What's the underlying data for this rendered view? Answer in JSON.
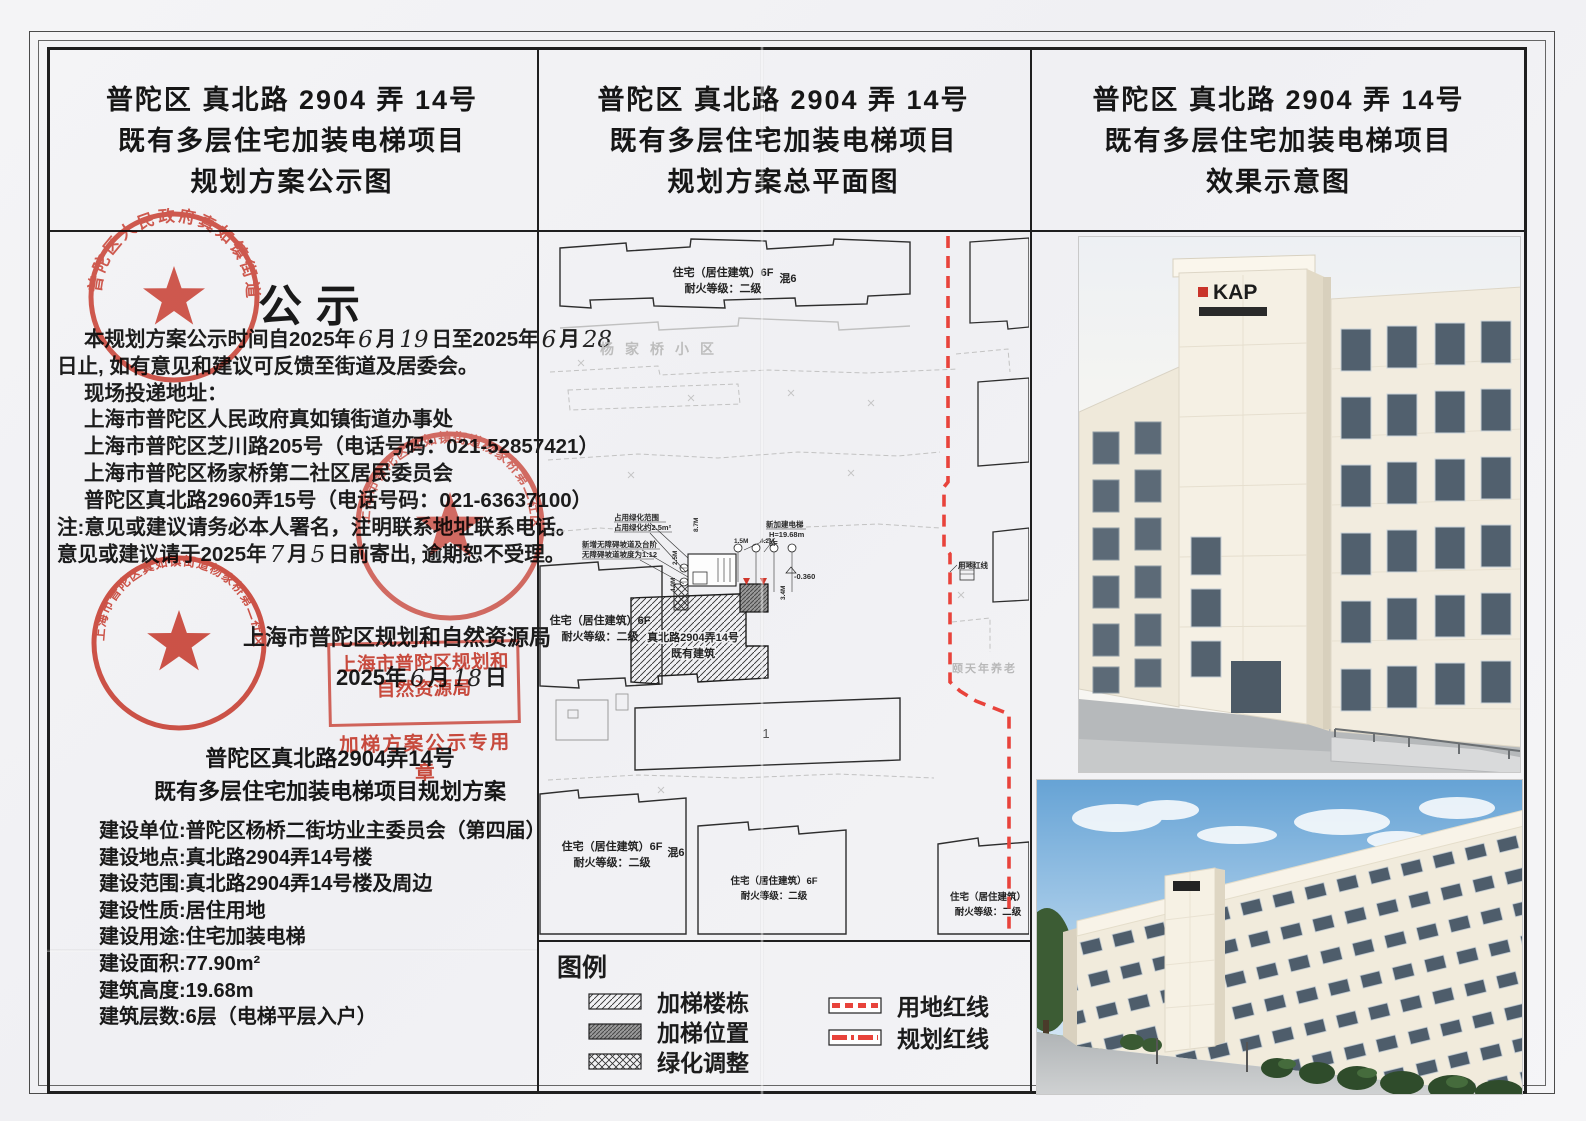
{
  "doc": {
    "title_line1": "普陀区 真北路 2904 弄 14号",
    "title_line2": "既有多层住宅加装电梯项目",
    "left_title_line3": "规划方案公示图",
    "mid_title_line3": "规划方案总平面图",
    "right_title_line3": "效果示意图"
  },
  "notice": {
    "heading": "公示",
    "line1_a": "本规划方案公示时间自2025年",
    "line1_m1": "6",
    "line1_b": "月",
    "line1_d1": "19",
    "line1_c": "日至2025年",
    "line1_m2": "6",
    "line1_d": "月",
    "line1_d2": "28",
    "line2": "日止, 如有意见和建议可反馈至街道及居委会。",
    "line3": "现场投递地址：",
    "addr1": "上海市普陀区人民政府真如镇街道办事处",
    "addr2": "上海市普陀区芝川路205号",
    "addr2_phone": "（电话号码：021-52857421）",
    "addr3": "上海市普陀区杨家桥第二社区居民委员会",
    "addr4": "普陀区真北路2960弄15号",
    "addr4_phone": "（电话号码：021-63637100）",
    "note1": "注:意见或建议请务必本人署名，注明联系地址联系电话。",
    "note2_a": "意见或建议请于2025年",
    "note2_m": "7",
    "note2_b": "月",
    "note2_d": "5",
    "note2_c": "日前寄出, 逾期恕不受理。"
  },
  "authority": {
    "name": "上海市普陀区规划和自然资源局",
    "date_a": "2025年",
    "date_m": "6",
    "date_b": "月",
    "date_d": "18",
    "date_c": "日",
    "stamp_line1": "上海市普陀区规划和自然资源局",
    "stamp_line2": "加梯方案公示专用章"
  },
  "stamps": {
    "street_office": "普陀区人民政府真如镇街道办事处",
    "community": "上海市普陀区真如镇街道杨家桥第二社区居民委员会"
  },
  "project": {
    "name_line1": "普陀区真北路2904弄14号",
    "name_line2": "既有多层住宅加装电梯项目规划方案",
    "fields": [
      {
        "label": "建设单位:",
        "value": "普陀区杨桥二街坊业主委员会（第四届）"
      },
      {
        "label": "建设地点:",
        "value": "真北路2904弄14号楼"
      },
      {
        "label": "建设范围:",
        "value": "真北路2904弄14号楼及周边"
      },
      {
        "label": "建设性质:",
        "value": "居住用地"
      },
      {
        "label": "建设用途:",
        "value": "住宅加装电梯"
      },
      {
        "label": "建设面积:",
        "value": "77.90m²"
      },
      {
        "label": "建筑高度:",
        "value": "19.68m"
      },
      {
        "label": "建筑层数:",
        "value": "6层（电梯平层入户）"
      }
    ]
  },
  "plan": {
    "res_label1": "住宅（居住建筑）6F",
    "res_label2": "耐火等级：二级",
    "res_label_short": "住宅（居住建筑）",
    "neighborhood": "杨家桥小区",
    "care_home": "颐天年养老",
    "redline_label": "用地红线",
    "existing1": "真北路2904弄14号",
    "existing2": "既有建筑",
    "ann_green1": "占用绿化范围",
    "ann_green2": "占用绿化约2.5m²",
    "ann_lift1": "新加建电梯",
    "ann_lift2": "H=19.68m",
    "ann_lift3": "6F",
    "ann_ramp1": "新增无障碍坡道及台阶",
    "ann_ramp2": "无障碍坡道坡度为1:12",
    "level": "-0.360",
    "dim_87": "8.7M",
    "dim_42": "4.2M",
    "dim_15": "1.5M",
    "dim_25": "2.5M",
    "dim_40": "4.0M",
    "dim_34": "3.4M",
    "block_no": "1",
    "gray_mark": "混6"
  },
  "legend": {
    "title": "图例",
    "item1": "加梯楼栋",
    "item2": "加梯位置",
    "item3": "绿化调整",
    "item4": "用地红线",
    "item5": "规划红线"
  },
  "render": {
    "logo_top": "KAP"
  },
  "colors": {
    "stamp_red": "#d03a2b",
    "red_line": "#e8433b",
    "ink": "#1d1d1d"
  }
}
